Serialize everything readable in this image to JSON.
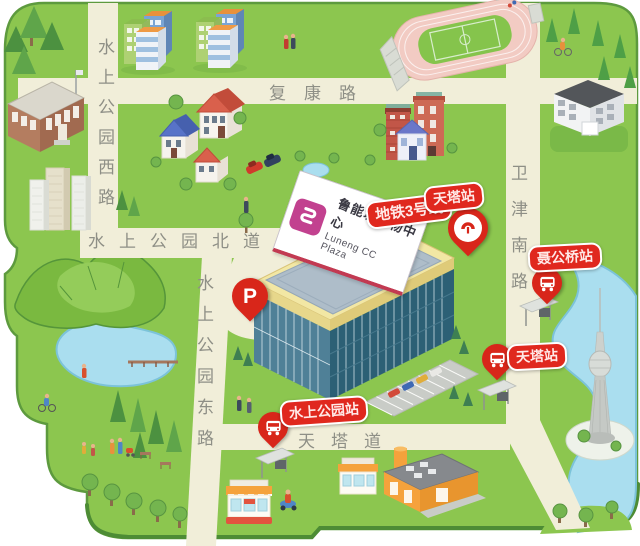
{
  "plaza": {
    "name_cn": "鲁能城购物中心",
    "name_en": "Luneng CC Plaza"
  },
  "roads": {
    "fukang": "复康路",
    "shuishang_west": "水上公园西路",
    "shuishang_north": "水上公园北道",
    "shuishang_east": "水上公园东路",
    "weijin_south": "卫津南路",
    "tianta": "天塔道"
  },
  "transit": {
    "metro_line": "地铁3号线",
    "metro_station_tianta": "天塔站",
    "bus_station_niegongqiao": "聂公桥站",
    "bus_station_tianta": "天塔站",
    "bus_station_shuishang_park": "水上公园站"
  },
  "parking": {
    "label": "P"
  },
  "icons": {
    "metro_pin": "metro-logo-icon",
    "bus_pin": "bus-icon",
    "parking_pin": "parking-p-icon"
  },
  "colors": {
    "map_green": "#8cc64f",
    "road_cream": "#f1eed9",
    "water_blue": "#aadeef",
    "marker_red": "#e0281e",
    "logo_pink": "#c2418f",
    "road_label_gray": "#8e8f86"
  }
}
